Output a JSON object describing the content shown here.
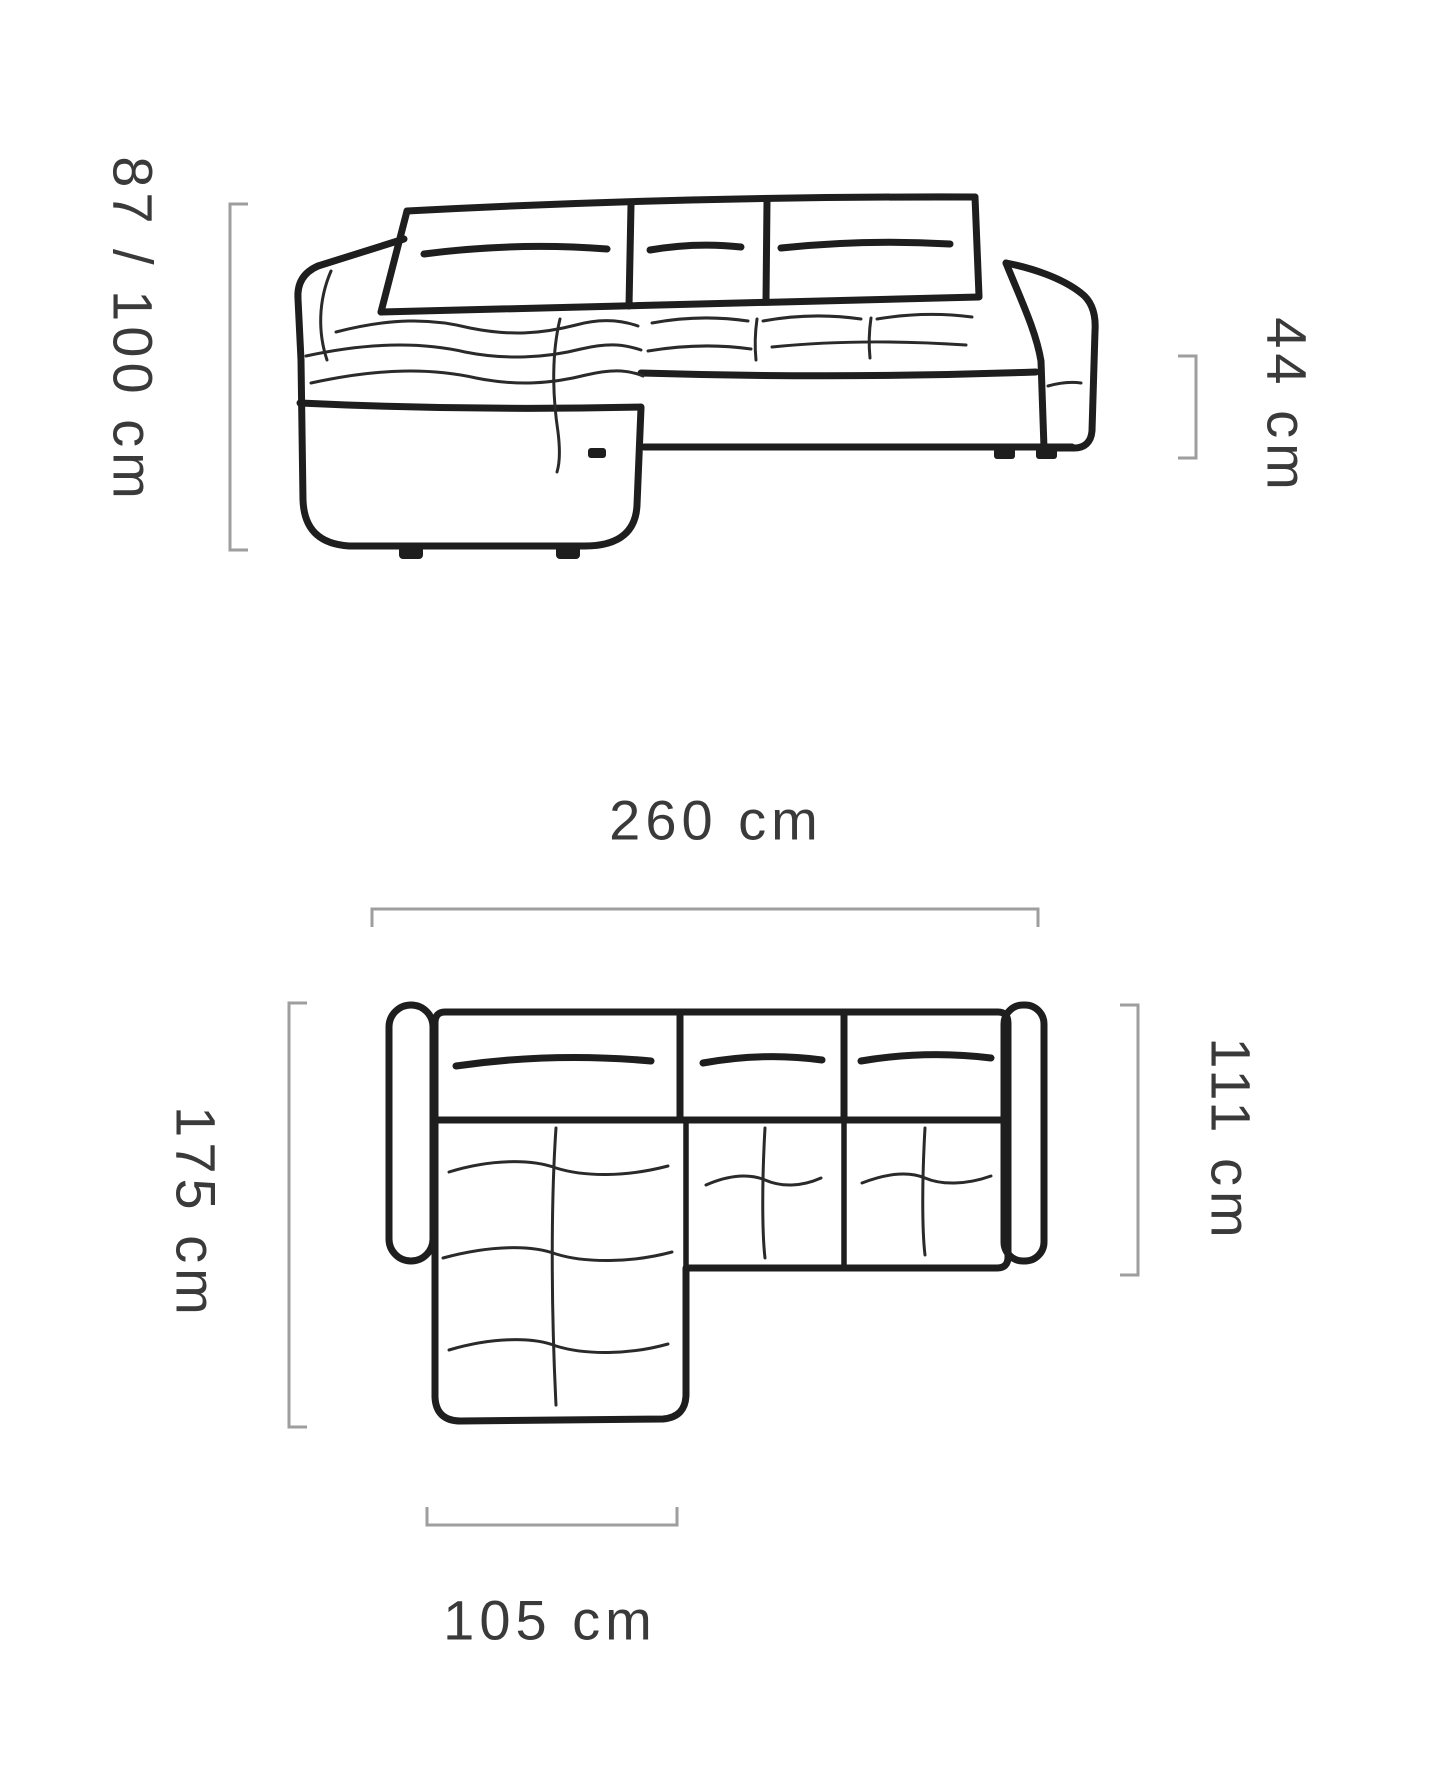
{
  "diagram": {
    "title": "corner-sofa-dimensions",
    "colors": {
      "background": "#ffffff",
      "drawing_line": "#1e1e1e",
      "bracket": "#9e9e9e",
      "label_text": "#3a3a3a"
    },
    "front_view": {
      "labels": {
        "height": "87 / 100 cm",
        "seat_height": "44 cm"
      }
    },
    "top_view": {
      "labels": {
        "total_width": "260 cm",
        "total_depth": "175 cm",
        "body_depth": "111 cm",
        "chaise_width": "105 cm"
      }
    }
  }
}
